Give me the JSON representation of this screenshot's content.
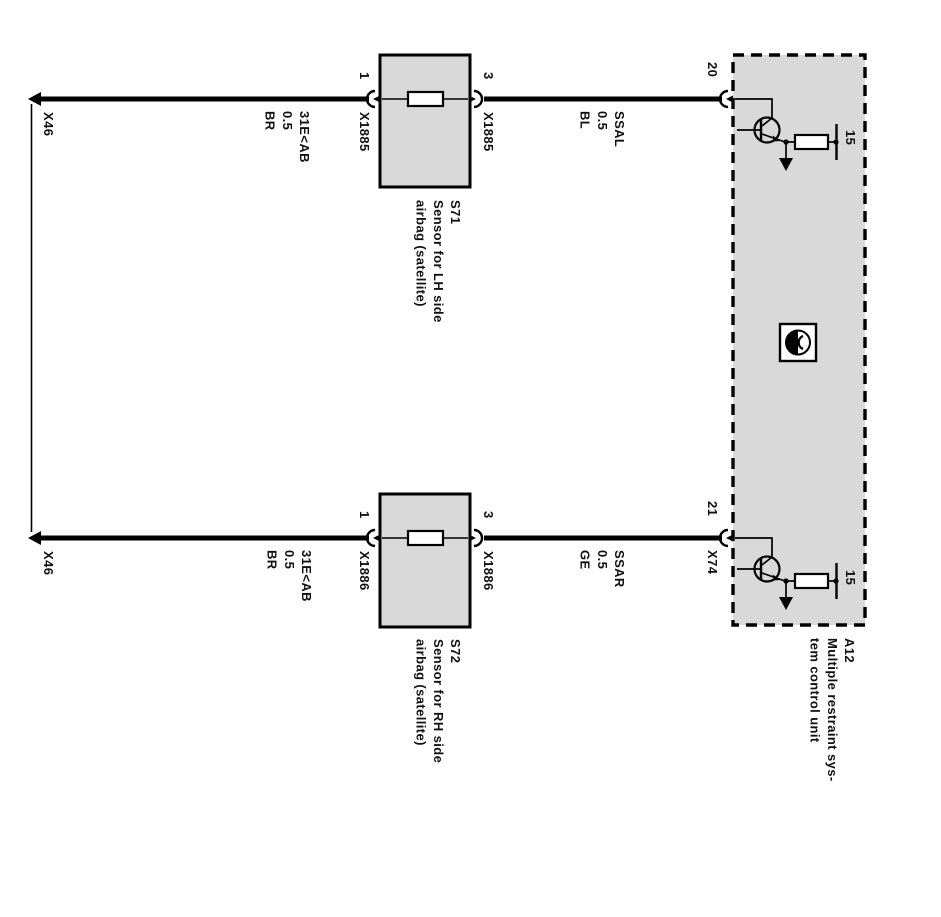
{
  "colors": {
    "box_fill": "#d9d9d9",
    "stroke": "#000000",
    "background": "#ffffff"
  },
  "left_rail": {
    "top_connector": "X46",
    "bottom_connector": "X46"
  },
  "wires": {
    "top_left": {
      "name": "31E<AB",
      "size": "0.5",
      "color_code": "BR"
    },
    "top_right": {
      "name": "SSAL",
      "size": "0.5",
      "color_code": "BL"
    },
    "bottom_left": {
      "name": "31E<AB",
      "size": "0.5",
      "color_code": "BR"
    },
    "bottom_right": {
      "name": "SSAR",
      "size": "0.5",
      "color_code": "GE"
    }
  },
  "sensor_top": {
    "id": "S71",
    "desc_line1": "Sensor for LH side",
    "desc_line2": "airbag (satellite)",
    "pin_left": "1",
    "pin_right": "3",
    "connector_left": "X1885",
    "connector_right": "X1885"
  },
  "sensor_bottom": {
    "id": "S72",
    "desc_line1": "Sensor for RH side",
    "desc_line2": "airbag (satellite)",
    "pin_left": "1",
    "pin_right": "3",
    "connector_left": "X1886",
    "connector_right": "X1886"
  },
  "control_unit": {
    "id": "A12",
    "desc_line1": "Multiple restraint sys-",
    "desc_line2": "tem control unit",
    "pin_top": "20",
    "pin_bottom": "21",
    "connector_bottom": "X74",
    "terminal_top": "15",
    "terminal_bottom": "15"
  }
}
